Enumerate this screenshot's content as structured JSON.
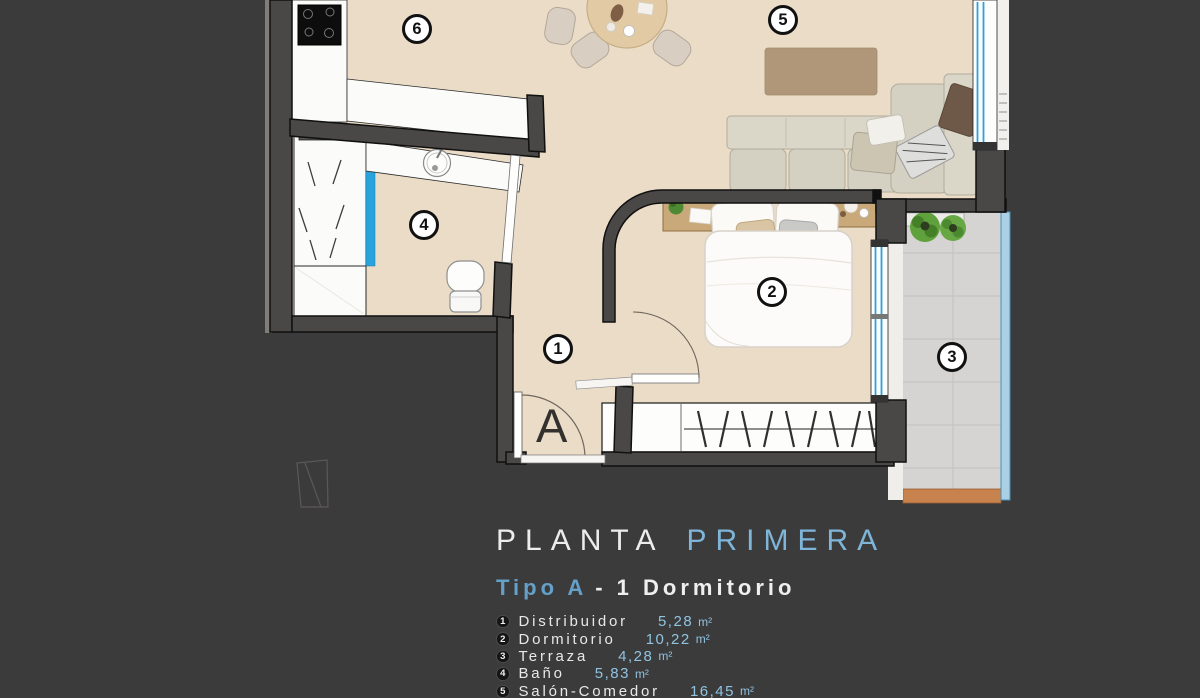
{
  "legend": {
    "title": {
      "primary": "PLANTA",
      "accent": "PRIMERA"
    },
    "subtitle": {
      "accent": "Tipo A",
      "rest": "- 1 Dormitorio"
    },
    "items": [
      {
        "num": "1",
        "name": "Distribuidor",
        "value": "5,28",
        "unit": "m²"
      },
      {
        "num": "2",
        "name": "Dormitorio",
        "value": "10,22",
        "unit": "m²"
      },
      {
        "num": "3",
        "name": "Terraza",
        "value": "4,28",
        "unit": "m²"
      },
      {
        "num": "4",
        "name": "Baño",
        "value": "5,83",
        "unit": "m²"
      },
      {
        "num": "5",
        "name": "Salón-Comedor",
        "value": "16,45",
        "unit": "m²"
      }
    ]
  },
  "floorplan": {
    "entrance_label": "A",
    "markers": [
      {
        "number": "1",
        "room": "distribuidor",
        "x": 558,
        "y": 349
      },
      {
        "number": "2",
        "room": "dormitorio",
        "x": 772,
        "y": 292
      },
      {
        "number": "3",
        "room": "terraza",
        "x": 952,
        "y": 357
      },
      {
        "number": "4",
        "room": "bano",
        "x": 424,
        "y": 225
      },
      {
        "number": "5",
        "room": "salon-comedor",
        "x": 783,
        "y": 20
      },
      {
        "number": "6",
        "room": "cocina",
        "x": 417,
        "y": 29
      }
    ]
  },
  "colors": {
    "background": "#3C3B3C",
    "floor": "#EADCC6",
    "wall": "#4A4846",
    "wall_outline": "#101010",
    "fixture_white": "#FBFBF9",
    "glass_blue": "#29A3DC",
    "railing_blue": "#ABD0E5",
    "tile": "#D5D4D2",
    "terrace_edge": "#C8824E",
    "rug": "#B1977A",
    "wood": "#C9A979",
    "sofa": "#D6D3C4",
    "plant": "#4E8A33",
    "title_primary": "#ECECEC",
    "title_accent": "#7EB5D8",
    "value_accent": "#8FC3E0",
    "marker_bg": "#FFFFFF",
    "marker_border": "#111111"
  }
}
